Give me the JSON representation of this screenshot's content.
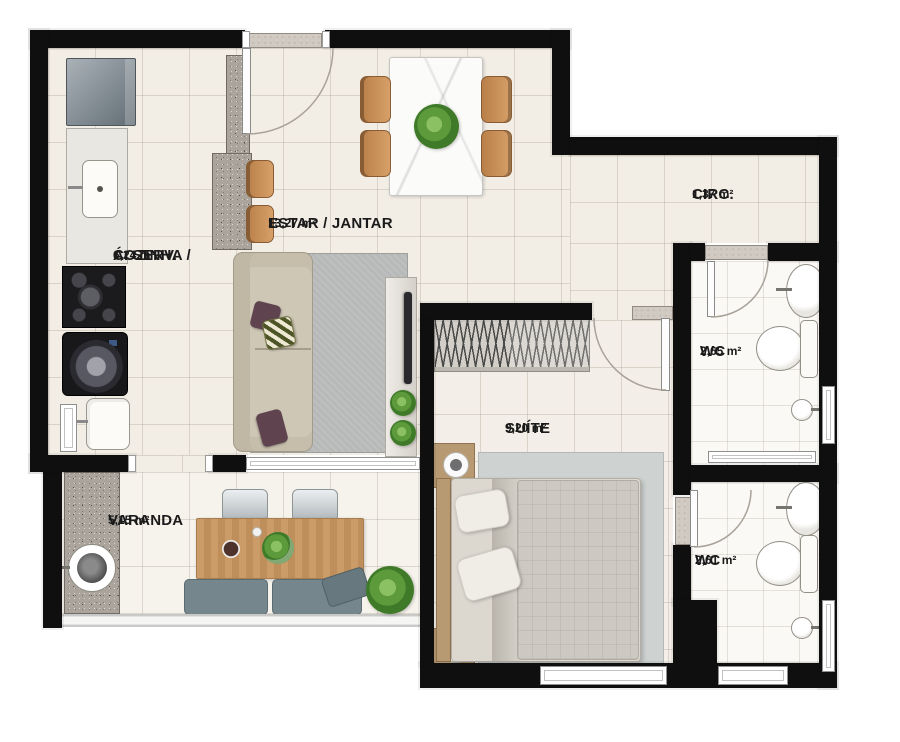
{
  "floor_plan": {
    "rooms": [
      {
        "id": "cozinha_aserv",
        "name": "COZINHA / Á. SERV.",
        "name_line1": "COZINHA /",
        "name_line2": "Á. SERV.",
        "area": "6,24 m²"
      },
      {
        "id": "estar_jantar",
        "name": "ESTAR / JANTAR",
        "area": "13,27 m²"
      },
      {
        "id": "circ",
        "name": "CIRC.",
        "area": "1,37 m²"
      },
      {
        "id": "wc_social",
        "name": "WC",
        "area": "2,65 m²"
      },
      {
        "id": "suite",
        "name": "SUÍTE",
        "area": "9,20 m²"
      },
      {
        "id": "wc_suite",
        "name": "WC",
        "area": "2,61 m²"
      },
      {
        "id": "varanda",
        "name": "VARANDA",
        "area": "5,15 m²"
      }
    ],
    "colors": {
      "wall": "#0f0f10",
      "floor_tile": "#f2ede5",
      "bathroom_tile": "#fbf9f5",
      "granite": "#aaa49c",
      "wood": "#c58b57",
      "sofa": "#cfc7b5",
      "rug": "#b6b9b7",
      "bed_rug": "#ced2d1",
      "plant": "#4b8033",
      "balcony_cushion": "#76868d",
      "accent_pillow": "#5f4450"
    },
    "furniture": [
      "refrigerator",
      "kitchen-counter-sink",
      "cooktop",
      "washing-machine",
      "laundry-tank",
      "breakfast-counter",
      "counter-stools",
      "entrance-door",
      "dining-table",
      "dining-chairs",
      "centerpiece-plant",
      "sofa",
      "area-rug",
      "throw-pillows",
      "tv-panel",
      "plants",
      "wardrobe-hangers",
      "double-bed",
      "nightstands",
      "bedside-lamps",
      "washbasin",
      "toilet",
      "shower",
      "sliding-glass-door",
      "balcony-sink",
      "balcony-table",
      "balcony-chairs",
      "balcony-bench",
      "balcony-plant",
      "glass-railing"
    ]
  }
}
